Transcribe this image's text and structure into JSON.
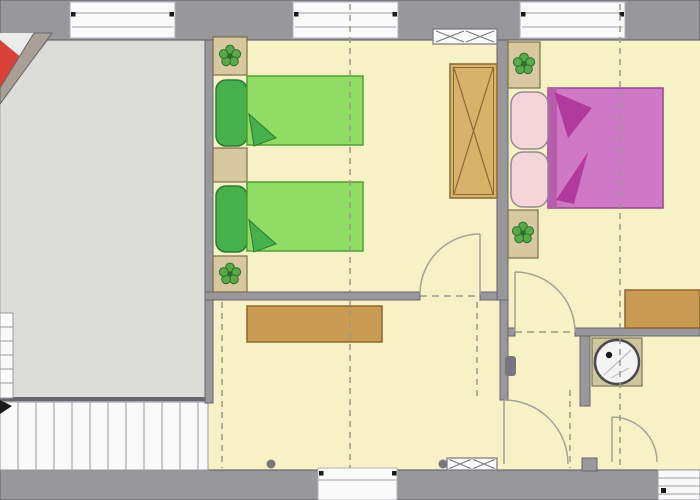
{
  "title": "apartment-upper-floor-plan",
  "colors": {
    "outside": "#a8a8ac",
    "wall": "#97979c",
    "wall_edge": "#66666c",
    "terrace": "#dcdcd9",
    "room_floor": "#f6f2c6",
    "white": "#fafafa",
    "window_frame": "#b2b2ba",
    "stair_line": "#9a9aa0",
    "black": "#1a1a1a",
    "furniture_tan": "#d8c8a0",
    "furniture_tan_border": "#7d6d48",
    "sideboard": "#c89a52",
    "sideboard_border": "#8a6530",
    "wardrobe": "#d9b26a",
    "wardrobe_border": "#8a6a35",
    "bed_green": "#90dc64",
    "bed_green_border": "#4f9e32",
    "pillow_green": "#46b04c",
    "pillow_green_border": "#2a7a30",
    "blanket_pink": "#cf79c6",
    "blanket_pink_border": "#94488c",
    "blanket_edge": "#ba5cae",
    "blanket_fold": "#b23a9c",
    "pillow_pink": "#f4d6da",
    "pillow_pink_border": "#98898c",
    "plant_green": "#5aa84c",
    "plant_green_dark": "#2d6e2b",
    "red_roof": "#d94038",
    "diagonal_wall": "#a8a096",
    "notch_white": "#ececec",
    "door_arc": "#a3a396",
    "dashed_line": "#9a9a86",
    "fixture_ring": "#4a4a4e",
    "fixture_fill": "#f4f4f4",
    "shower_base": "#cdc79e",
    "shower_base_border": "#7a745a",
    "blob_gray": "#77777d"
  },
  "rooms": [
    {
      "name": "gallery-terrace",
      "floor": "gray"
    },
    {
      "name": "bedroom-left",
      "floor": "yellow",
      "furniture": [
        "nightstand",
        "twin-bed-1",
        "nightstand",
        "twin-bed-2",
        "nightstand",
        "wardrobe",
        "radiator"
      ]
    },
    {
      "name": "bedroom-right",
      "floor": "yellow",
      "furniture": [
        "nightstand",
        "double-bed",
        "nightstand",
        "dresser"
      ]
    },
    {
      "name": "hallway",
      "floor": "yellow",
      "furniture": [
        "sideboard",
        "radiator"
      ]
    },
    {
      "name": "bathroom",
      "floor": "yellow",
      "furniture": [
        "round-shower-basin"
      ]
    }
  ],
  "fixtures": {
    "windows_top": 3,
    "window_bottom": 1,
    "interior_doors": 4,
    "staircase_flights": 2,
    "plant_symbols": 4,
    "radiators": 2
  }
}
